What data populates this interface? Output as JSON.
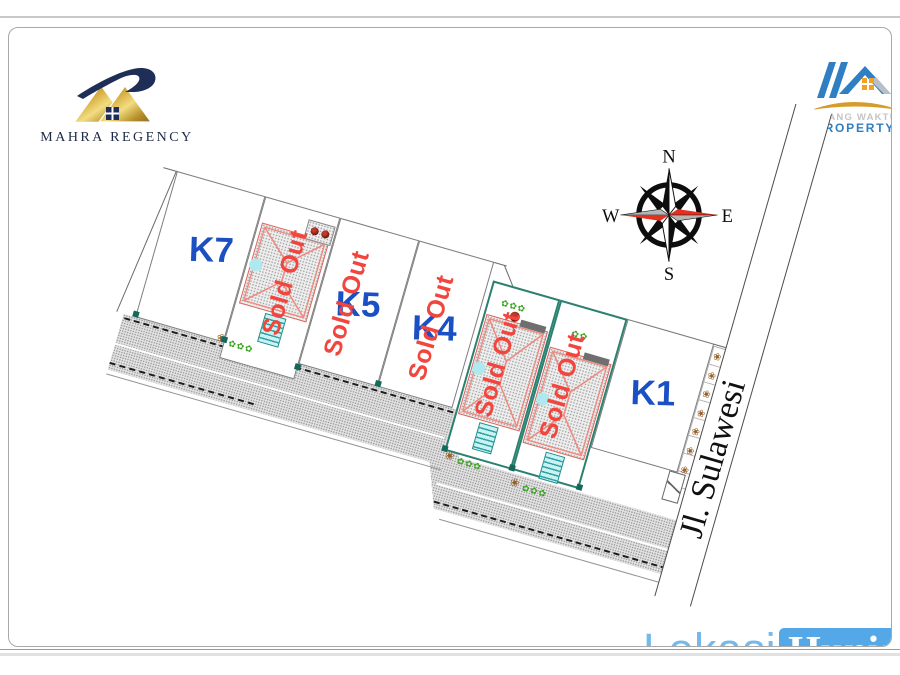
{
  "header": {
    "developer": {
      "name": "MAHRA REGENCY"
    },
    "agency": {
      "line1": "RUANG WAKTU",
      "line2": "PROPERTY"
    }
  },
  "compass": {
    "n": "N",
    "e": "E",
    "s": "S",
    "w": "W"
  },
  "plan": {
    "street": {
      "label": "Jl. Sulawesi"
    },
    "plots": [
      {
        "label": "K7",
        "status": "available",
        "type": "empty"
      },
      {
        "label": "",
        "status": "sold",
        "sold_label": "Sold Out",
        "type": "house"
      },
      {
        "label": "K5",
        "status": "sold",
        "sold_label": "Sold Out",
        "type": "empty"
      },
      {
        "label": "K4",
        "status": "sold",
        "sold_label": "Sold Out",
        "type": "empty"
      },
      {
        "label": "",
        "status": "sold",
        "sold_label": "Sold Out",
        "type": "house"
      },
      {
        "label": "",
        "status": "sold",
        "sold_label": "Sold Out",
        "type": "house"
      },
      {
        "label": "K1",
        "status": "available",
        "type": "empty"
      }
    ]
  },
  "decor": {
    "flowers_row": "✿✿✿",
    "flowers_pair": "✿✿",
    "flower_brown": "❀",
    "strip_column": "❀\n❀\n❀\n❀\n❀\n❀\n❀"
  },
  "footer": {
    "brand": {
      "word1": "Lokasi",
      "word2": "Hunian"
    }
  },
  "colors": {
    "plot_label_blue": "#1b50c4",
    "sold_red": "#f2453e",
    "green_plot_border": "#2b8171",
    "footer_blue": "#55a8e8",
    "gold": "#c9a23a",
    "navy": "#1f2e57"
  }
}
